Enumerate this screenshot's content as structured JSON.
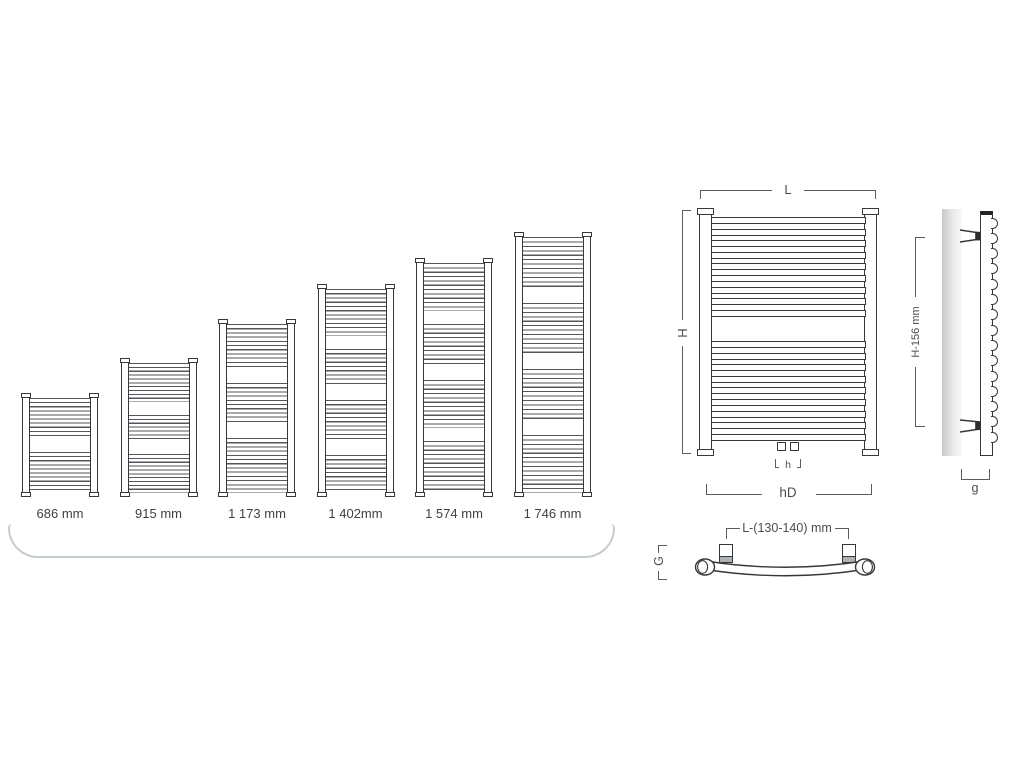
{
  "size_chart": {
    "unit": "mm",
    "items": [
      {
        "label": "686 mm",
        "height_mm": 686,
        "groups": [
          10,
          10
        ]
      },
      {
        "label": "915 mm",
        "height_mm": 915,
        "groups": [
          10,
          7,
          10
        ]
      },
      {
        "label": "1 173 mm",
        "height_mm": 1173,
        "groups": [
          11,
          10,
          13
        ]
      },
      {
        "label": "1 402mm",
        "height_mm": 1402,
        "groups": [
          11,
          9,
          10,
          9
        ]
      },
      {
        "label": "1 574 mm",
        "height_mm": 1574,
        "groups": [
          11,
          10,
          11,
          12
        ]
      },
      {
        "label": "1 746 mm",
        "height_mm": 1746,
        "groups": [
          12,
          12,
          12,
          13
        ]
      }
    ]
  },
  "front_view": {
    "width_label": "L",
    "height_label": "H",
    "valve_spacing_label": "h",
    "bottom_width_label": "hD"
  },
  "side_view": {
    "height_label": "H-156 mm",
    "depth_label": "g"
  },
  "top_view": {
    "bracket_spacing_label": "L-(130-140) mm",
    "depth_label": "G"
  },
  "colors": {
    "drawing_line": "#36393b",
    "dimension_line": "#5a5d5f",
    "label_text": "#3d4144",
    "tray_line": "#c3cdcf"
  }
}
